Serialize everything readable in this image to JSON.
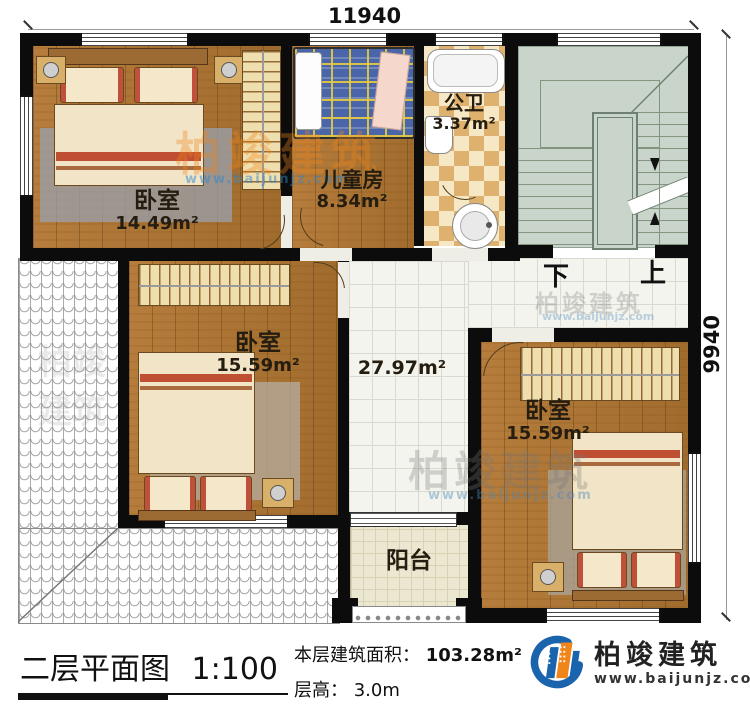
{
  "dimensions": {
    "width_mm": "11940",
    "height_mm": "9940"
  },
  "rooms": {
    "bedroom1": {
      "name": "卧室",
      "area": "14.49m²"
    },
    "kids_room": {
      "name": "儿童房",
      "area": "8.34m²"
    },
    "bathroom": {
      "name": "公卫",
      "area": "3.37m²"
    },
    "bedroom2": {
      "name": "卧室",
      "area": "15.59m²"
    },
    "hall": {
      "area": "27.97m²"
    },
    "bedroom3": {
      "name": "卧室",
      "area": "15.59m²"
    },
    "balcony": {
      "name": "阳台"
    }
  },
  "stairs": {
    "down_label": "下",
    "up_label": "上"
  },
  "footer": {
    "plan_title": "二层平面图",
    "plan_scale": "1:100",
    "floor_area_label": "本层建筑面积：",
    "floor_area_value": "103.28m²",
    "floor_height_label": "层高：",
    "floor_height_value": "3.0m"
  },
  "logo": {
    "company": "柏竣建筑",
    "website": "www.baijunjz.com"
  },
  "watermark": {
    "text": "柏竣建筑",
    "subtext": "www.baijunjz.com"
  },
  "colors": {
    "wall": "#0c0c0c",
    "wood": "#ad7535",
    "stairs": "#c9d4ca",
    "checker": "#dfb16e",
    "accent_blue": "#1a63ad",
    "accent_orange": "#f08519"
  }
}
